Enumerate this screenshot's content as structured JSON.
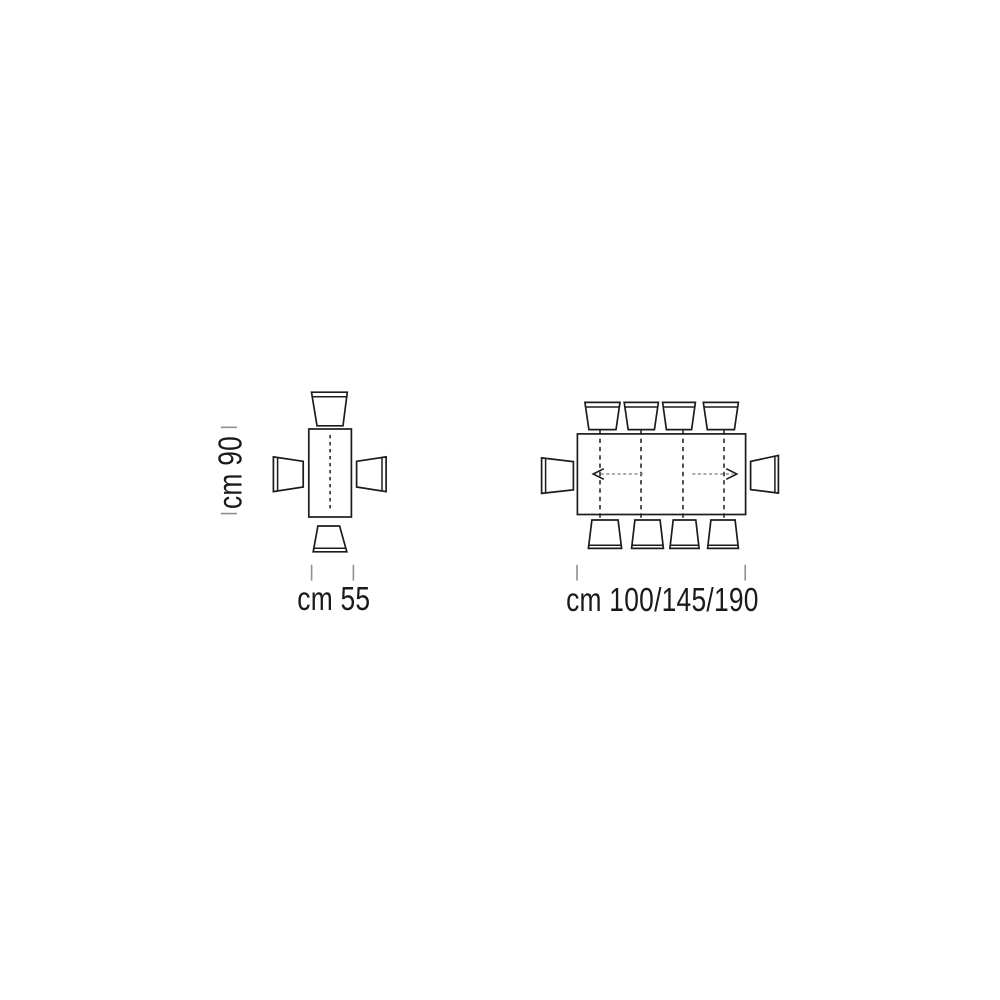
{
  "colors": {
    "background": "#ffffff",
    "line": "#1c1c1c",
    "text": "#1a1a1a",
    "tick": "#909090",
    "arrow_shaft": "#8f8f8f"
  },
  "small_table_diagram": {
    "type": "top-view table with 4 chairs",
    "chair_count": 4,
    "height_dimension": {
      "label": "cm 90"
    },
    "width_dimension": {
      "label": "cm 55"
    }
  },
  "large_table_diagram": {
    "type": "top-view extendable table with 10 chairs",
    "chair_count": 10,
    "extension_arrows": [
      "left",
      "right"
    ],
    "width_dimension": {
      "label": "cm 100/145/190"
    }
  }
}
